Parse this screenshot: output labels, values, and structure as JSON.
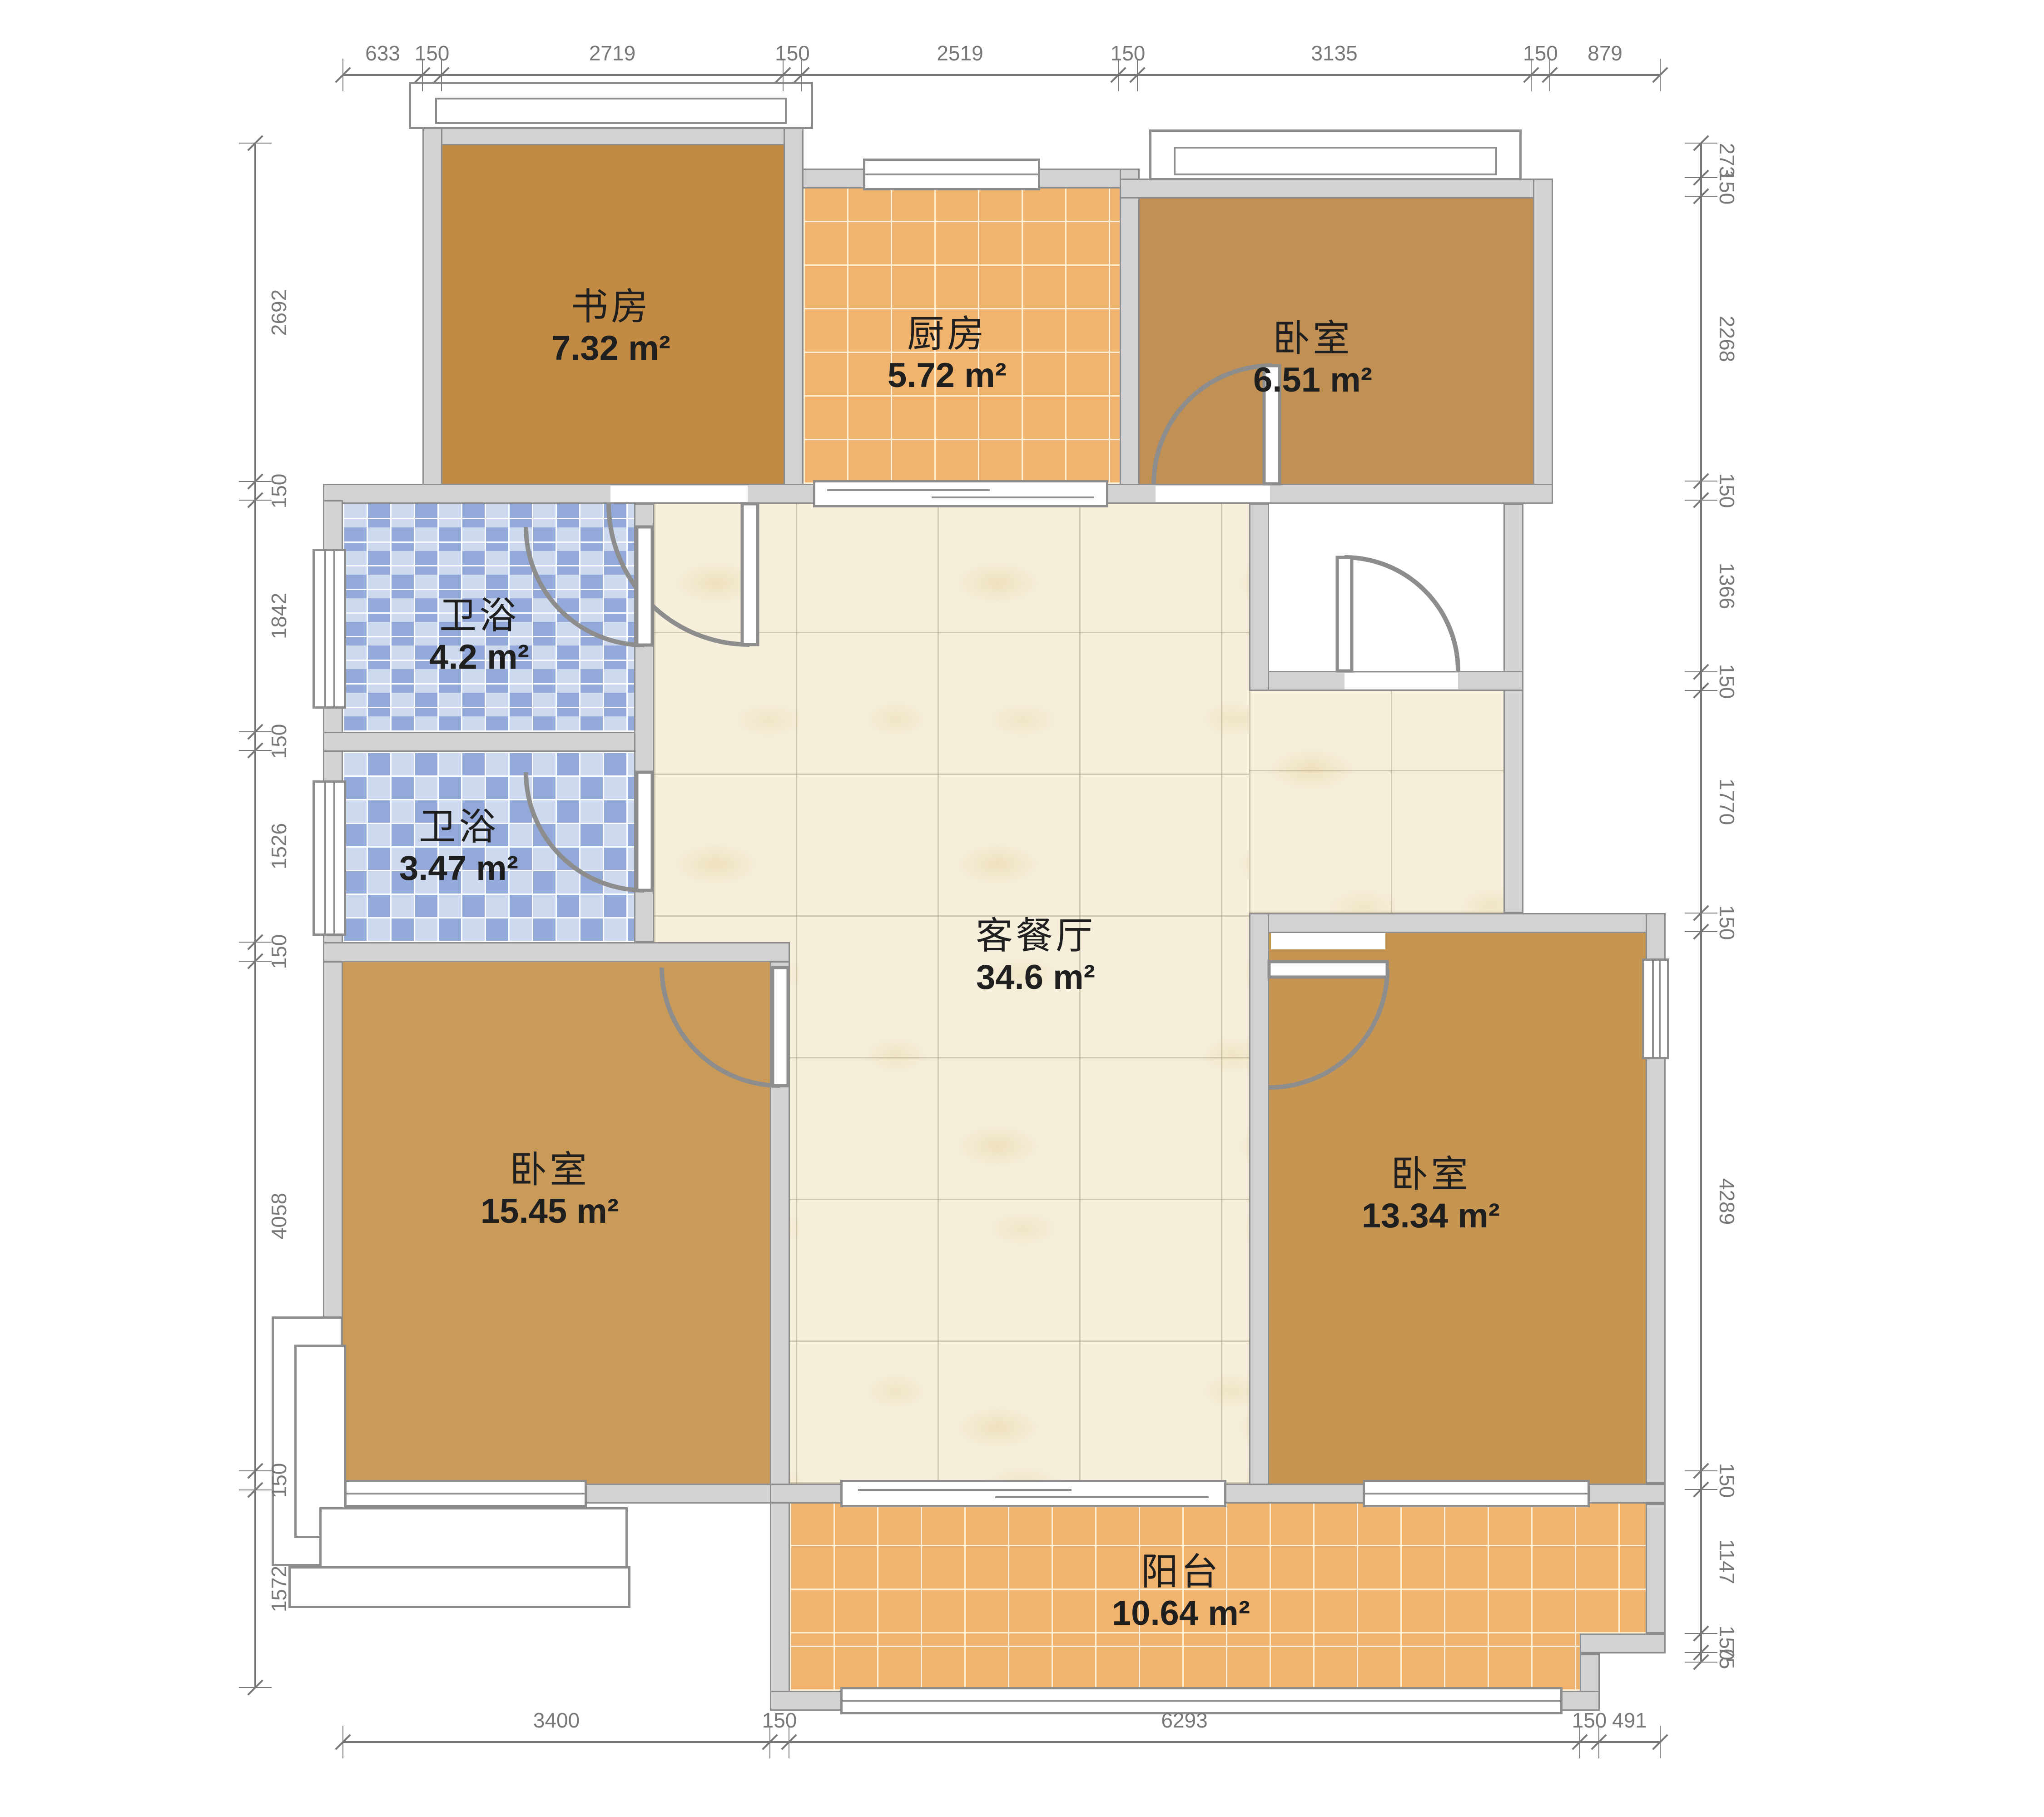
{
  "rooms": [
    {
      "key": "study",
      "name": "书房",
      "area": "7.32 m²"
    },
    {
      "key": "kitchen",
      "name": "厨房",
      "area": "5.72 m²"
    },
    {
      "key": "bedroom-top-right",
      "name": "卧室",
      "area": "6.51 m²"
    },
    {
      "key": "bath-upper",
      "name": "卫浴",
      "area": "4.2 m²"
    },
    {
      "key": "bath-lower",
      "name": "卫浴",
      "area": "3.47 m²"
    },
    {
      "key": "bedroom-left",
      "name": "卧室",
      "area": "15.45 m²"
    },
    {
      "key": "living-dining",
      "name": "客餐厅",
      "area": "34.6 m²"
    },
    {
      "key": "bedroom-right",
      "name": "卧室",
      "area": "13.34 m²"
    },
    {
      "key": "balcony",
      "name": "阳台",
      "area": "10.64 m²"
    }
  ],
  "dimensions": {
    "top": [
      "633",
      "150",
      "2719",
      "150",
      "2519",
      "150",
      "3135",
      "150",
      "879"
    ],
    "bottom": [
      "3400",
      "150",
      "6293",
      "150",
      "491"
    ],
    "left": [
      "2692",
      "150",
      "1842",
      "150",
      "1526",
      "150",
      "4058",
      "150",
      "1572"
    ],
    "right": [
      "273",
      "150",
      "2268",
      "150",
      "1366",
      "150",
      "1770",
      "150",
      "4289",
      "150",
      "1147",
      "150",
      "75"
    ]
  },
  "colors": {
    "wall": "#d2d2d2",
    "wallStroke": "#8d8d8d",
    "dim": "#787878",
    "text": "#1f1f1f",
    "woodStudy": "#c2префик8a43",
    "woodA": "#c09055",
    "woodB": "#ca9a58",
    "woodC": "#c69552",
    "tileOrange": "#f0b46e",
    "mosaicLight": "#ccd9ee",
    "mosaicDark": "#93a9da",
    "marble": "#f6efdc"
  }
}
